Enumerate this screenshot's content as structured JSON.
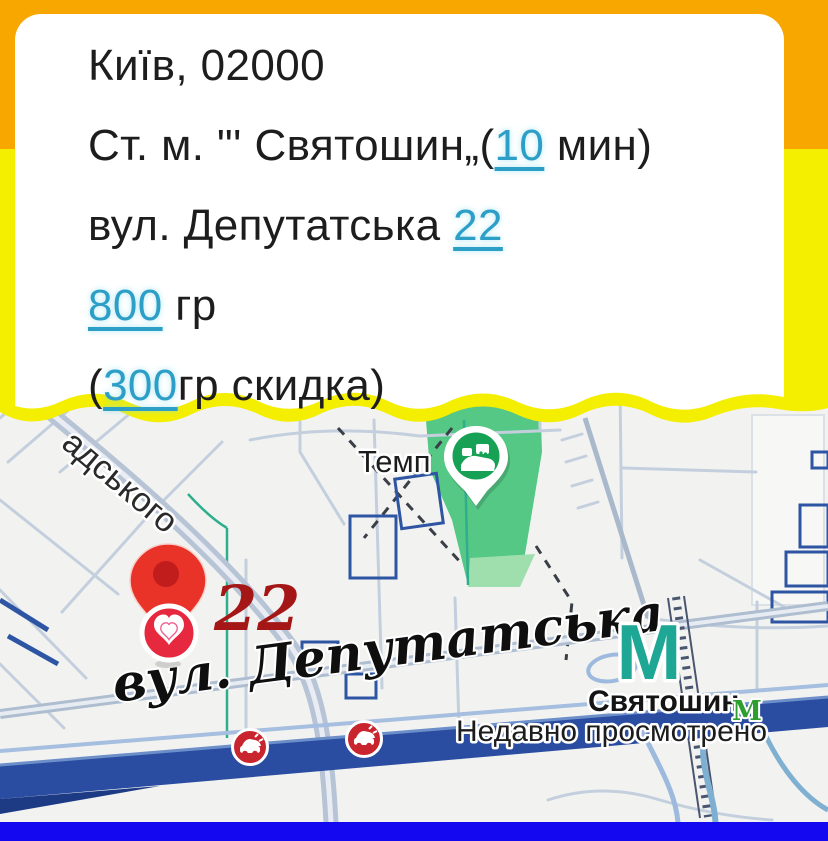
{
  "card": {
    "line1": {
      "text": "Київ, 02000"
    },
    "line2": {
      "prefix": "Ст. м. \"' Святошин„(",
      "link": "10",
      "suffix": " мин)"
    },
    "line3": {
      "prefix": "вул. Депутатська ",
      "link": "22",
      "suffix": ""
    },
    "line4": {
      "prefix": "",
      "link": "800",
      "suffix": " гр"
    },
    "line5": {
      "prefix": "(",
      "link": "300",
      "suffix": "гр скидка)"
    }
  },
  "map": {
    "street_partial": "адського",
    "poi_temp": "Темп",
    "house_number": "22",
    "street_main": "вул. Депутатська",
    "metro_letter": "М",
    "metro_station": "Святошин",
    "metro_logo": "М",
    "status": "Недавно просмотрено"
  },
  "colors": {
    "orange": "#F8A600",
    "yellow": "#F4EE00",
    "link": "#2D9EC6",
    "text": "#1D1D1D",
    "bottom-bar": "#1408F0",
    "highway": "#2B4DA1",
    "park": "#4CC57E",
    "park-light": "#9FDFAE",
    "pin-red": "#E93228",
    "pin-inner": "#C11D1D",
    "badge-red": "#E7293F",
    "number-red": "#A51616",
    "metro-teal": "#1FA796",
    "metro-green": "#2E9E2F",
    "poi-red": "#C8252E",
    "poi-green": "#16A155"
  }
}
